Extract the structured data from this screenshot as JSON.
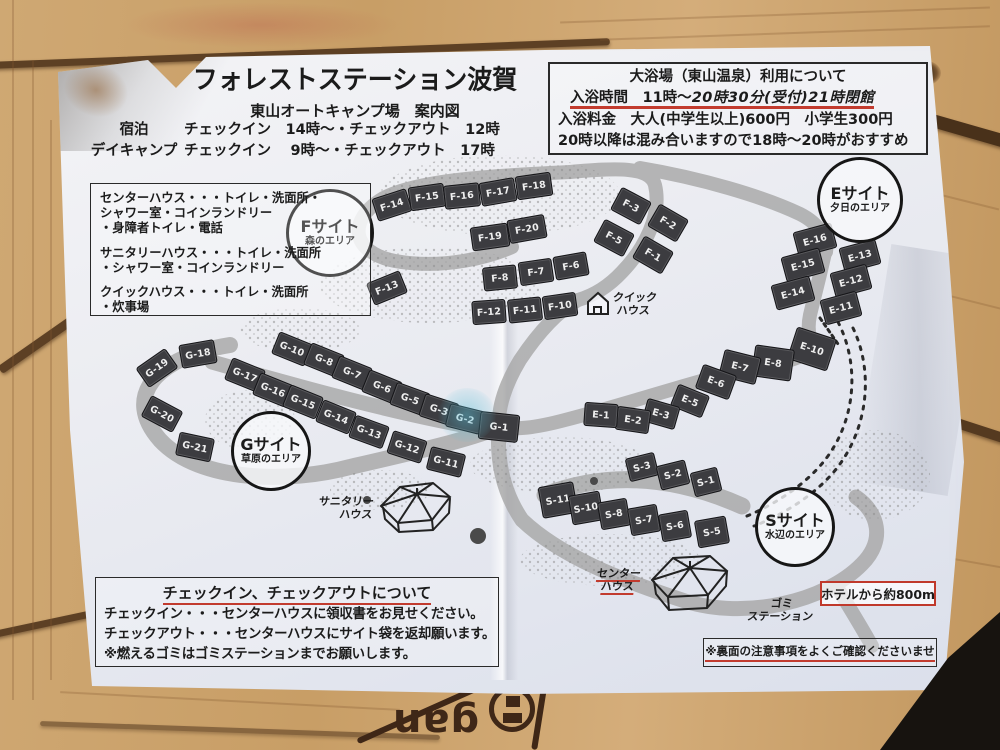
{
  "colors": {
    "accent_red": "#c23b2e",
    "site_box": "#3c3c40",
    "road": "#a8a8a8",
    "paper": "#eef0f4",
    "wood": "#c9a06a"
  },
  "header": {
    "title": "フォレストステーション波賀",
    "subtitle": "東山オートキャンプ場　案内図",
    "schedule": [
      {
        "label": "宿泊",
        "text": "チェックイン　14時〜・チェックアウト　12時"
      },
      {
        "label": "デイキャンプ",
        "text": "チェックイン　 9時〜・チェックアウト　17時"
      }
    ]
  },
  "bath": {
    "title": "大浴場（東山温泉）利用について",
    "hours_printed": "入浴時間　11時〜",
    "hours_handwritten": "20時30分(受付)21時閉館",
    "fee": "入浴料金　大人(中学生以上)600円　小学生300円",
    "note": "20時以降は混み合いますので18時〜20時がおすすめ"
  },
  "legend": {
    "items": [
      "センターハウス・・・トイレ・洗面所・\nシャワー室・コインランドリー\n・身障者トイレ・電話",
      "サニタリーハウス・・・トイレ・洗面所\n・シャワー室・コインランドリー",
      "クイックハウス・・・トイレ・洗面所\n・炊事場"
    ]
  },
  "checkin": {
    "title": "チェックイン、チェックアウトについて",
    "lines": [
      "チェックイン・・・センターハウスに領収書をお見せください。",
      "チェックアウト・・・センターハウスにサイト袋を返却願います。",
      "※燃えるゴミはゴミステーションまでお願いします。"
    ]
  },
  "back_note": "※裏面の注意事項をよくご確認くださいませ",
  "hotel_note": "ホテルから約800m",
  "table_logo_text": "gan",
  "map": {
    "areas": [
      {
        "name": "Fサイト",
        "sub": "森のエリア",
        "x": 330,
        "y": 233,
        "r": 44
      },
      {
        "name": "Eサイト",
        "sub": "夕日のエリア",
        "x": 860,
        "y": 200,
        "r": 43
      },
      {
        "name": "Gサイト",
        "sub": "草原のエリア",
        "x": 271,
        "y": 451,
        "r": 40
      },
      {
        "name": "Sサイト",
        "sub": "水辺のエリア",
        "x": 795,
        "y": 527,
        "r": 40
      }
    ],
    "buildings": [
      {
        "id": "quick-house",
        "label": "クイック\nハウス"
      },
      {
        "id": "sanitary-house",
        "label": "サニタリー\nハウス"
      },
      {
        "id": "center-house",
        "label": "センター\nハウス"
      },
      {
        "id": "gomi-station",
        "label": "ゴミ\nステーション"
      }
    ],
    "sites": [
      {
        "label": "F-14",
        "x": 392,
        "y": 205,
        "rot": -18,
        "w": 36,
        "h": 24
      },
      {
        "label": "F-15",
        "x": 427,
        "y": 197,
        "rot": -8,
        "w": 36,
        "h": 24
      },
      {
        "label": "F-16",
        "x": 462,
        "y": 196,
        "rot": -6,
        "w": 36,
        "h": 24
      },
      {
        "label": "F-17",
        "x": 498,
        "y": 192,
        "rot": -10,
        "w": 36,
        "h": 24
      },
      {
        "label": "F-18",
        "x": 534,
        "y": 186,
        "rot": -8,
        "w": 36,
        "h": 24
      },
      {
        "label": "F-19",
        "x": 490,
        "y": 237,
        "rot": -8,
        "w": 38,
        "h": 24
      },
      {
        "label": "F-20",
        "x": 527,
        "y": 229,
        "rot": -10,
        "w": 38,
        "h": 24
      },
      {
        "label": "F-3",
        "x": 631,
        "y": 206,
        "rot": 28,
        "w": 34,
        "h": 26
      },
      {
        "label": "F-2",
        "x": 668,
        "y": 223,
        "rot": 30,
        "w": 34,
        "h": 26
      },
      {
        "label": "F-5",
        "x": 614,
        "y": 238,
        "rot": 28,
        "w": 34,
        "h": 26
      },
      {
        "label": "F-1",
        "x": 653,
        "y": 255,
        "rot": 30,
        "w": 34,
        "h": 26
      },
      {
        "label": "F-8",
        "x": 500,
        "y": 278,
        "rot": -6,
        "w": 34,
        "h": 24
      },
      {
        "label": "F-7",
        "x": 536,
        "y": 272,
        "rot": -8,
        "w": 34,
        "h": 24
      },
      {
        "label": "F-6",
        "x": 571,
        "y": 266,
        "rot": -10,
        "w": 34,
        "h": 24
      },
      {
        "label": "F-13",
        "x": 387,
        "y": 288,
        "rot": -22,
        "w": 36,
        "h": 24
      },
      {
        "label": "F-12",
        "x": 489,
        "y": 312,
        "rot": -4,
        "w": 34,
        "h": 24
      },
      {
        "label": "F-11",
        "x": 525,
        "y": 310,
        "rot": -6,
        "w": 34,
        "h": 24
      },
      {
        "label": "F-10",
        "x": 560,
        "y": 306,
        "rot": -8,
        "w": 34,
        "h": 24
      },
      {
        "label": "E-16",
        "x": 815,
        "y": 240,
        "rot": -15,
        "w": 40,
        "h": 26
      },
      {
        "label": "E-13",
        "x": 860,
        "y": 256,
        "rot": -15,
        "w": 38,
        "h": 26
      },
      {
        "label": "E-15",
        "x": 803,
        "y": 265,
        "rot": -15,
        "w": 40,
        "h": 26
      },
      {
        "label": "E-12",
        "x": 851,
        "y": 281,
        "rot": -15,
        "w": 38,
        "h": 26
      },
      {
        "label": "E-14",
        "x": 793,
        "y": 293,
        "rot": -15,
        "w": 40,
        "h": 26
      },
      {
        "label": "E-11",
        "x": 841,
        "y": 308,
        "rot": -15,
        "w": 38,
        "h": 26
      },
      {
        "label": "E-10",
        "x": 812,
        "y": 349,
        "rot": 18,
        "w": 42,
        "h": 34
      },
      {
        "label": "E-8",
        "x": 773,
        "y": 363,
        "rot": 8,
        "w": 40,
        "h": 32
      },
      {
        "label": "E-7",
        "x": 740,
        "y": 367,
        "rot": 14,
        "w": 38,
        "h": 28
      },
      {
        "label": "E-6",
        "x": 716,
        "y": 382,
        "rot": 20,
        "w": 36,
        "h": 26
      },
      {
        "label": "E-5",
        "x": 690,
        "y": 401,
        "rot": 22,
        "w": 34,
        "h": 24
      },
      {
        "label": "E-3",
        "x": 661,
        "y": 414,
        "rot": 16,
        "w": 34,
        "h": 24
      },
      {
        "label": "E-2",
        "x": 633,
        "y": 420,
        "rot": 8,
        "w": 34,
        "h": 24
      },
      {
        "label": "E-1",
        "x": 601,
        "y": 415,
        "rot": 4,
        "w": 34,
        "h": 24
      },
      {
        "label": "G-10",
        "x": 292,
        "y": 349,
        "rot": 22,
        "w": 36,
        "h": 24
      },
      {
        "label": "G-8",
        "x": 324,
        "y": 360,
        "rot": 22,
        "w": 36,
        "h": 24
      },
      {
        "label": "G-7",
        "x": 352,
        "y": 373,
        "rot": 22,
        "w": 36,
        "h": 24
      },
      {
        "label": "G-6",
        "x": 382,
        "y": 387,
        "rot": 22,
        "w": 36,
        "h": 24
      },
      {
        "label": "G-5",
        "x": 410,
        "y": 399,
        "rot": 20,
        "w": 36,
        "h": 24
      },
      {
        "label": "G-3",
        "x": 439,
        "y": 410,
        "rot": 18,
        "w": 36,
        "h": 24
      },
      {
        "label": "G-2",
        "x": 465,
        "y": 419,
        "rot": 14,
        "w": 36,
        "h": 24
      },
      {
        "label": "G-1",
        "x": 499,
        "y": 427,
        "rot": 6,
        "w": 40,
        "h": 28
      },
      {
        "label": "G-17",
        "x": 245,
        "y": 375,
        "rot": 22,
        "w": 36,
        "h": 24
      },
      {
        "label": "G-16",
        "x": 273,
        "y": 390,
        "rot": 22,
        "w": 36,
        "h": 24
      },
      {
        "label": "G-15",
        "x": 303,
        "y": 402,
        "rot": 22,
        "w": 36,
        "h": 24
      },
      {
        "label": "G-14",
        "x": 336,
        "y": 417,
        "rot": 22,
        "w": 36,
        "h": 24
      },
      {
        "label": "G-13",
        "x": 369,
        "y": 432,
        "rot": 20,
        "w": 36,
        "h": 24
      },
      {
        "label": "G-12",
        "x": 407,
        "y": 447,
        "rot": 18,
        "w": 36,
        "h": 24
      },
      {
        "label": "G-11",
        "x": 446,
        "y": 462,
        "rot": 14,
        "w": 36,
        "h": 24
      },
      {
        "label": "G-18",
        "x": 198,
        "y": 354,
        "rot": -10,
        "w": 36,
        "h": 24
      },
      {
        "label": "G-19",
        "x": 157,
        "y": 368,
        "rot": -35,
        "w": 36,
        "h": 24
      },
      {
        "label": "G-20",
        "x": 162,
        "y": 414,
        "rot": 28,
        "w": 36,
        "h": 24
      },
      {
        "label": "G-21",
        "x": 195,
        "y": 447,
        "rot": 12,
        "w": 36,
        "h": 24
      },
      {
        "label": "S-3",
        "x": 642,
        "y": 467,
        "rot": -14,
        "w": 30,
        "h": 24
      },
      {
        "label": "S-2",
        "x": 673,
        "y": 475,
        "rot": -14,
        "w": 30,
        "h": 25
      },
      {
        "label": "S-1",
        "x": 706,
        "y": 482,
        "rot": -14,
        "w": 28,
        "h": 25
      },
      {
        "label": "S-11",
        "x": 558,
        "y": 500,
        "rot": -10,
        "w": 36,
        "h": 32
      },
      {
        "label": "S-10",
        "x": 586,
        "y": 508,
        "rot": -10,
        "w": 32,
        "h": 30
      },
      {
        "label": "S-8",
        "x": 614,
        "y": 514,
        "rot": -10,
        "w": 30,
        "h": 28
      },
      {
        "label": "S-7",
        "x": 644,
        "y": 520,
        "rot": -10,
        "w": 30,
        "h": 28
      },
      {
        "label": "S-6",
        "x": 675,
        "y": 526,
        "rot": -10,
        "w": 30,
        "h": 28
      },
      {
        "label": "S-5",
        "x": 712,
        "y": 532,
        "rot": -10,
        "w": 32,
        "h": 28
      }
    ]
  }
}
